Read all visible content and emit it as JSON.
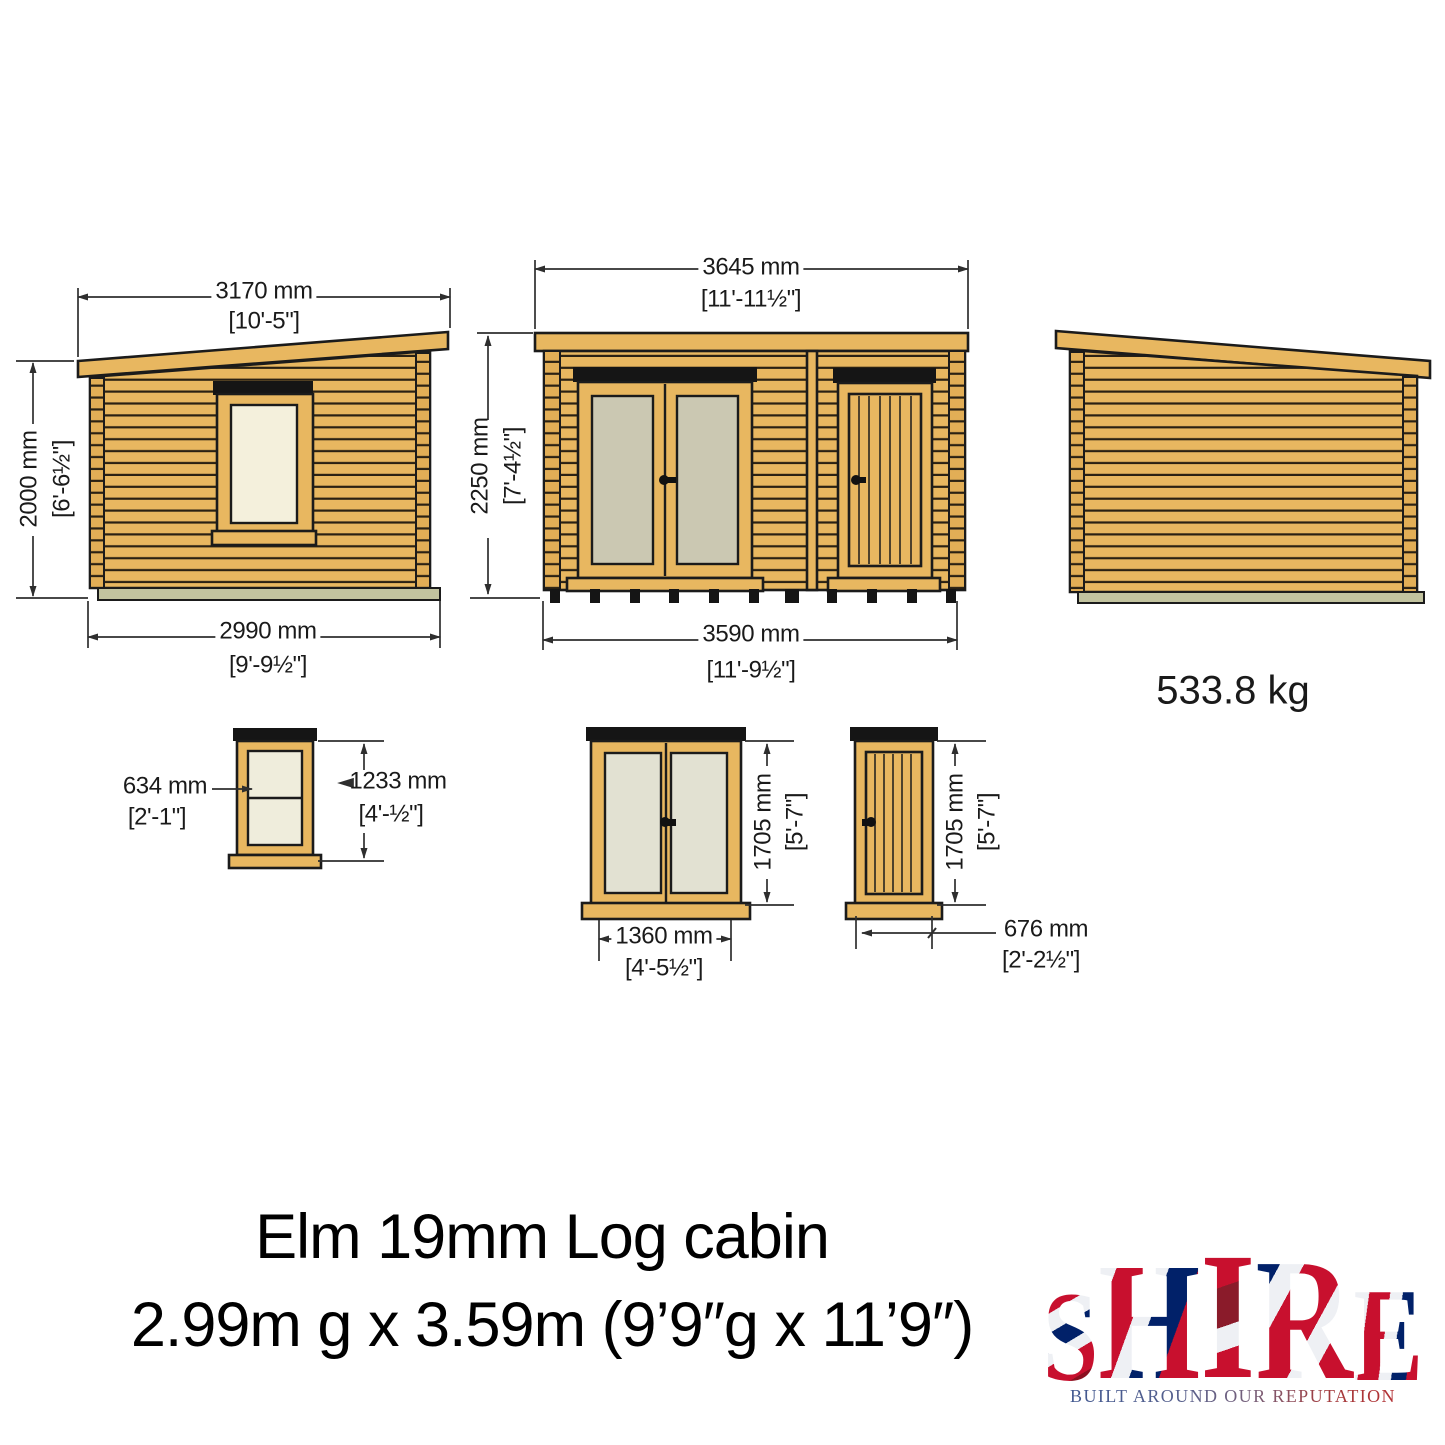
{
  "drawing": {
    "side_left": {
      "top_mm": "3170 mm",
      "top_ft": "[10'-5\"]",
      "height_mm": "2000 mm",
      "height_ft": "[6'-6½\"]",
      "bottom_mm": "2990 mm",
      "bottom_ft": "[9'-9½\"]"
    },
    "front": {
      "top_mm": "3645 mm",
      "top_ft": "[11'-11½\"]",
      "height_mm": "2250 mm",
      "height_ft": "[7'-4½\"]",
      "bottom_mm": "3590 mm",
      "bottom_ft": "[11'-9½\"]"
    },
    "side_right": {
      "weight": "533.8 kg"
    },
    "window": {
      "width_mm": "634 mm",
      "width_ft": "[2'-1\"]",
      "height_mm": "1233 mm",
      "height_ft": "[4'-½\"]"
    },
    "double_door": {
      "width_mm": "1360 mm",
      "width_ft": "[4'-5½\"]",
      "height_mm": "1705 mm",
      "height_ft": "[5'-7\"]"
    },
    "single_door": {
      "width_mm": "676 mm",
      "width_ft": "[2'-2½\"]",
      "height_mm": "1705 mm",
      "height_ft": "[5'-7\"]"
    }
  },
  "title": {
    "line1": "Elm 19mm Log cabin",
    "line2": "2.99m g x 3.59m (9’9″g x 11’9″)"
  },
  "logo": {
    "letters": [
      "S",
      "H",
      "I",
      "R",
      "E"
    ],
    "tagline": "BUILT AROUND OUR REPUTATION"
  },
  "colors": {
    "wood": "#E8B760",
    "outline": "#1A1A1A",
    "window_glass": "#F4F0DC",
    "front_door_glass": "#CBC8B2",
    "detail_door_glass": "#E2E1D2",
    "floor_bearer": "#C2C39F",
    "header_bar": "#151515",
    "dimension_line": "#2E2E2E"
  }
}
